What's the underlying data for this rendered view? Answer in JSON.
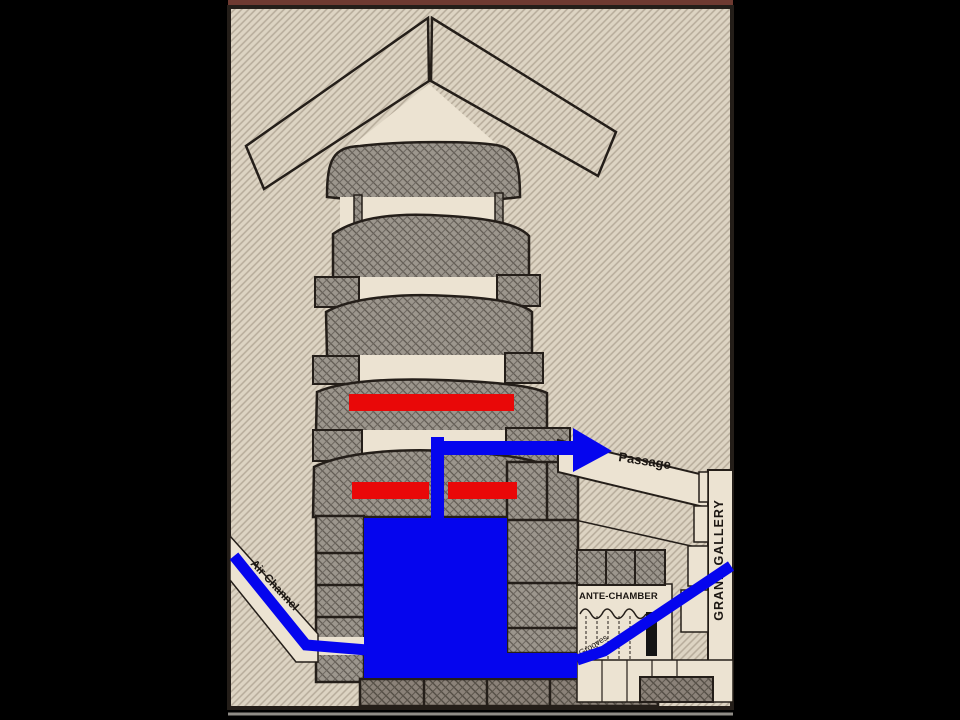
{
  "scene": {
    "labels": {
      "passage": "Passage",
      "air_channel": "Air Channel",
      "ante_chamber": "ANTE-CHAMBER",
      "grand_gallery": "GRAND GALLERY",
      "grooves": "Grooves"
    },
    "colors": {
      "letterbox": "#000000",
      "panel_background": "#ddd4c3",
      "panel_top_strip": "#6e3a31",
      "outline": "#241e19",
      "void_white": "#ece3d2",
      "masonry_gray": "#9c968d",
      "masonry_dark": "#8b8279",
      "overlay_blue": "#0505ee",
      "overlay_red": "#e90808",
      "portcullis_black": "#141414"
    }
  }
}
